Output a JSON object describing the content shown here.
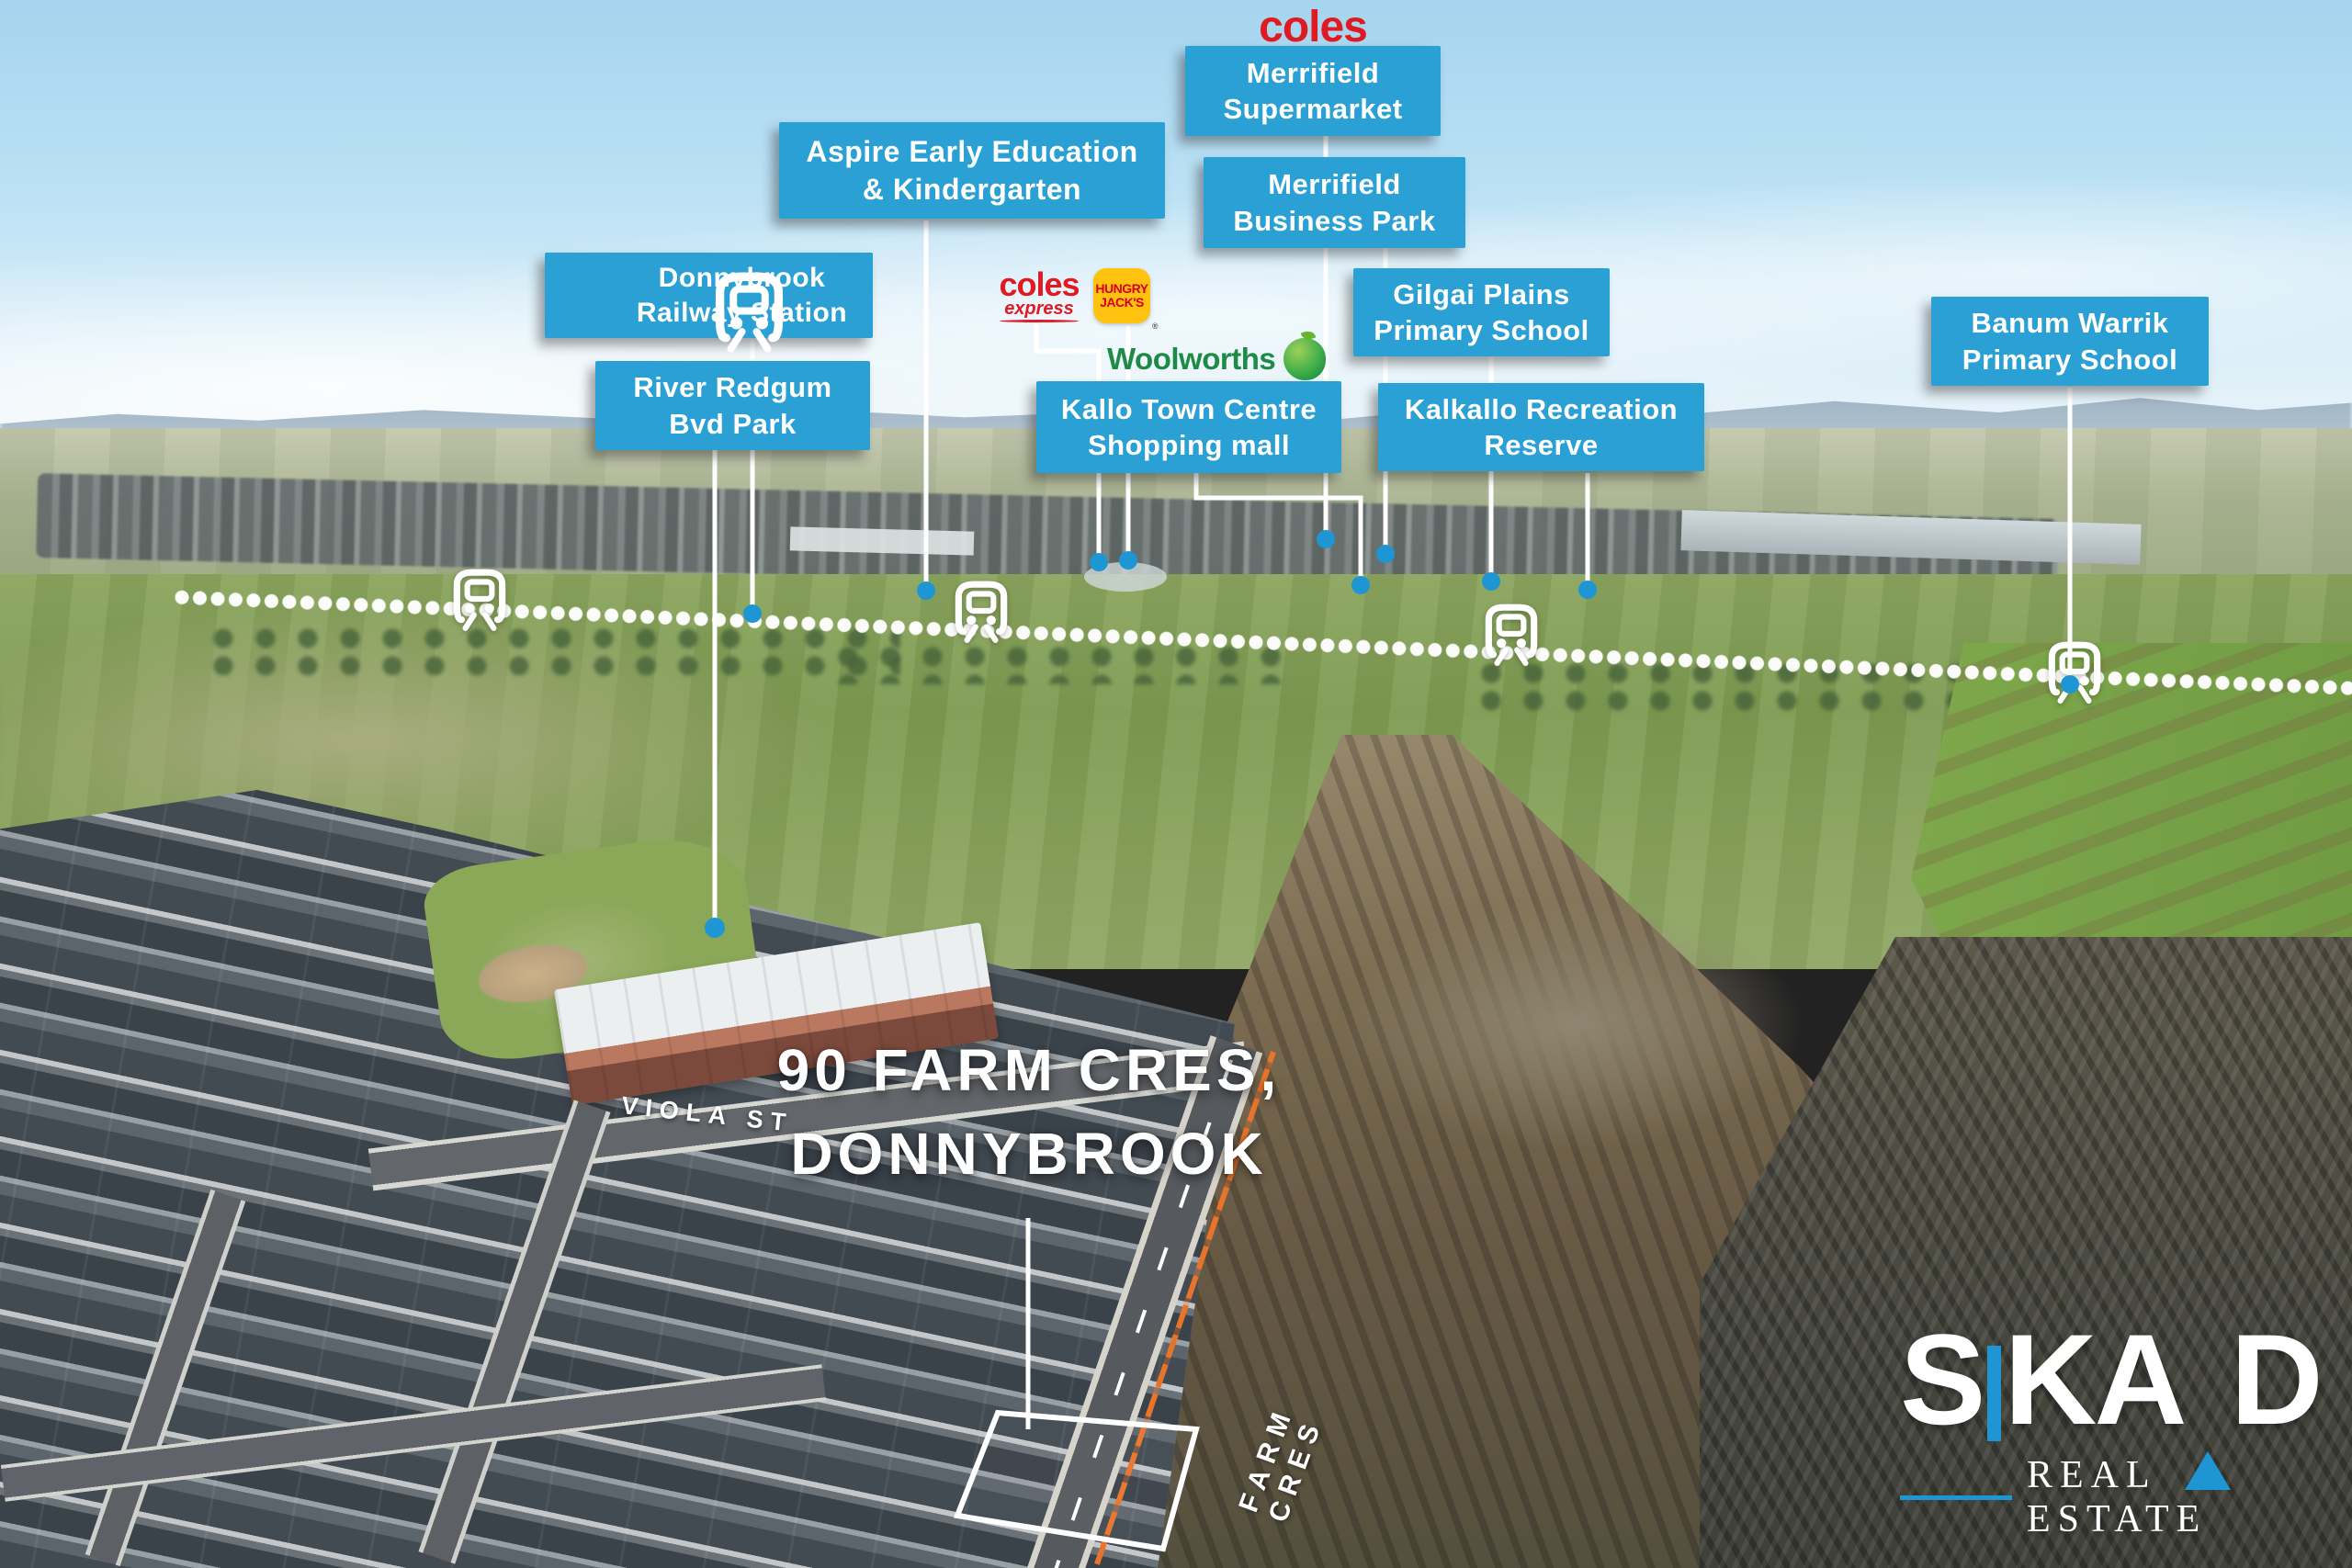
{
  "title": {
    "line1": "90 FARM CRES,",
    "line2": "DONNYBROOK"
  },
  "streets": {
    "viola": "VIOLA ST",
    "farm": "FARM CRES"
  },
  "labels": {
    "aspire": {
      "line1": "Aspire Early Education",
      "line2": "& Kindergarten"
    },
    "supermarket": {
      "line1": "Merrifield",
      "line2": "Supermarket"
    },
    "business_park": {
      "line1": "Merrifield",
      "line2": "Business Park"
    },
    "station": {
      "line1": "Donnybrook",
      "line2": "Railway Station"
    },
    "river_redgum": {
      "line1": "River Redgum",
      "line2": "Bvd Park"
    },
    "kallo": {
      "line1": "Kallo Town Centre",
      "line2": "Shopping mall"
    },
    "gilgai": {
      "line1": "Gilgai Plains",
      "line2": "Primary School"
    },
    "kalkallo": {
      "line1": "Kalkallo Recreation",
      "line2": "Reserve"
    },
    "banum": {
      "line1": "Banum Warrik",
      "line2": "Primary School"
    }
  },
  "logos": {
    "coles": "coles",
    "coles_express": {
      "name": "coles",
      "sub": "express"
    },
    "hungry_jacks": {
      "line1": "HUNGRY",
      "line2": "JACK'S",
      "reg": "®"
    },
    "woolworths": {
      "name": "Woolworths"
    }
  },
  "brand": {
    "letters": {
      "s": "S",
      "k": "K",
      "a": "A",
      "d": "D"
    },
    "tagline": "REAL ESTATE"
  },
  "colors": {
    "label_blue": "#2aa0d5",
    "dot_blue": "#1e96d4",
    "coles_red": "#e01a22",
    "hungry_jacks_yellow": "#ffc20e",
    "hungry_jacks_red": "#d6001c",
    "woolworths_green": "#1d8a45",
    "skad_blue": "#1e96d4"
  }
}
